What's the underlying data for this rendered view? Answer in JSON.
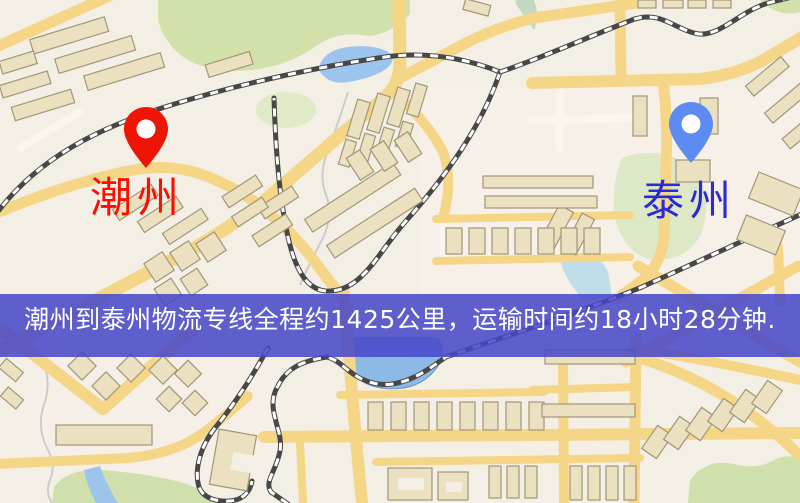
{
  "map": {
    "origin": {
      "label": "潮州",
      "label_color": "#fe0d00",
      "pin_color": "#ee1506"
    },
    "destination": {
      "label": "泰州",
      "label_color": "#2a2ad8",
      "pin_color": "#5c8cf2"
    },
    "banner": {
      "text": "潮州到泰州物流专线全程约1425公里，运输时间约18小时28分钟.",
      "distance": "约1425公里",
      "duration": "约18小时28分钟",
      "background_color": "#4646c8",
      "text_color": "#ffffff"
    },
    "icons": {
      "origin_pin": "map-pin-icon",
      "destination_pin": "map-pin-icon"
    },
    "legend_colors": {
      "land": "#f4efe5",
      "road_yellow": "#f5d687",
      "building": "#ebe1c1",
      "park_green": "#d2e0aa",
      "water_blue": "#9cc4ec",
      "railway_dark": "#474747"
    }
  }
}
